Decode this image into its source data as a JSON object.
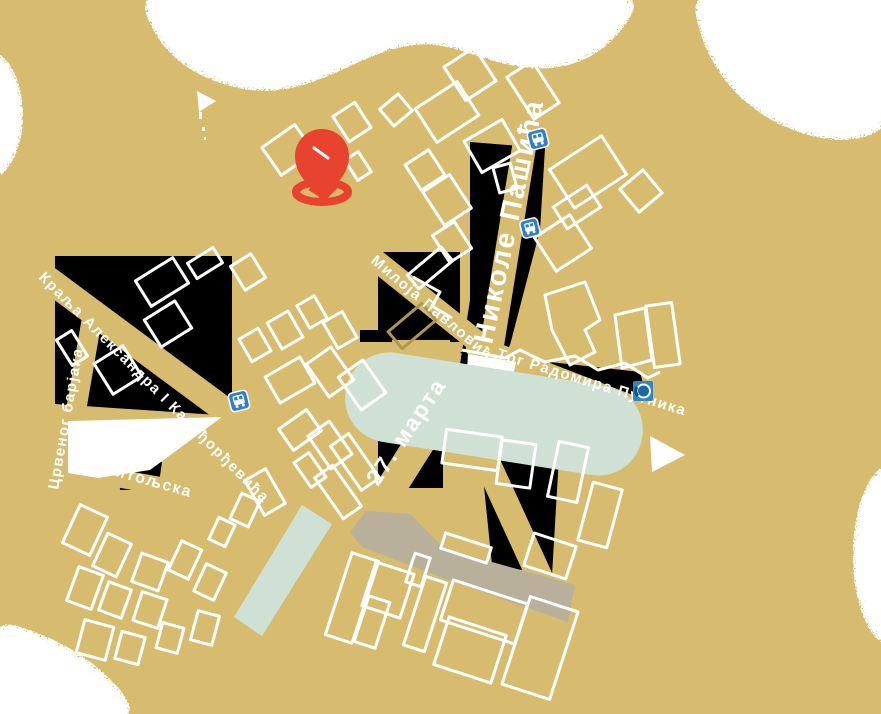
{
  "map": {
    "kind": "city-street-map",
    "street_labels": {
      "nikole_pasica": "Николе Пашића",
      "kralja_aleksandra": "Краља Александра I Карађорђевића",
      "crvenog_barjaka": "Црвеног барјака",
      "bitoljska": "Битољска",
      "miloja_pavlovica": "Милоја Павловића",
      "marta27": "27. марта",
      "trg_radomira_putnika": "Трг Радомира Путника"
    },
    "icons": [
      {
        "name": "location-pin-icon",
        "color": "#e8432e"
      },
      {
        "name": "bus-stop-icon",
        "count": 3,
        "color": "#2f7fd0"
      },
      {
        "name": "fountain-icon",
        "color": "#2e86c9"
      }
    ],
    "colors": {
      "land": "#d7bb6e",
      "building_outline": "#ffffff",
      "render_artifact": "#000000",
      "park": "#cfe1d5",
      "pavement": "#b8b09a",
      "cloud": "#ffffff",
      "pin": "#e8432e",
      "transit_blue": "#2f7fd0",
      "fountain_blue": "#2e86c9"
    }
  }
}
